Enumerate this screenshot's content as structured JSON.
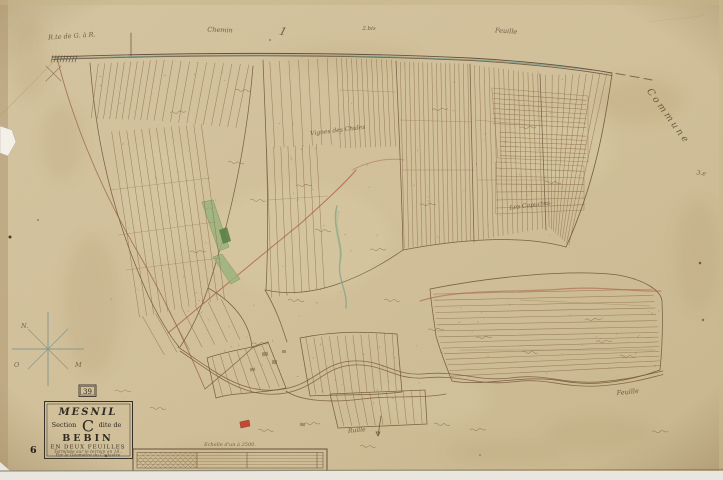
{
  "cartouche": {
    "commune_name": "MESNIL",
    "section_pre": "Section",
    "section_letter": "C",
    "section_post": "dite de",
    "lieu_name": "BEBIN",
    "subtitle": "EN DEUX FEUILLES",
    "note1": "Terminée sur le terrain en 18..",
    "note2": "Par le Géomètre du Cadastre"
  },
  "plaque_number": "39",
  "page_number": "6",
  "scale_bar": {
    "label": "Echelle d'un à 2500."
  },
  "compass": {
    "letters": [
      {
        "text": "N.",
        "x": 21,
        "y": 328
      },
      {
        "text": "O",
        "x": 14,
        "y": 367
      },
      {
        "text": "M",
        "x": 75,
        "y": 367
      }
    ]
  },
  "map_labels": [
    {
      "id": "route-top-left",
      "text": "R.te de G. à R.",
      "x": 72,
      "y": 38,
      "rot": -4,
      "size": 6.5
    },
    {
      "id": "chemin-top",
      "text": "Chemin",
      "x": 220,
      "y": 32,
      "rot": 2,
      "size": 6.5
    },
    {
      "id": "mark-1",
      "text": "1",
      "x": 282,
      "y": 35,
      "rot": 16,
      "size": 11
    },
    {
      "id": "mark-2bis",
      "text": "2.bis",
      "x": 369,
      "y": 30,
      "rot": 0,
      "size": 5.5
    },
    {
      "id": "feuille-top",
      "text": "Feuille",
      "x": 506,
      "y": 33,
      "rot": 4,
      "size": 6.5
    },
    {
      "id": "commune-right",
      "text": "Commune",
      "x": 666,
      "y": 118,
      "rot": 54,
      "size": 9.5,
      "ls": 2.5
    },
    {
      "id": "mark-3e",
      "text": "3.e",
      "x": 701,
      "y": 175,
      "rot": 8,
      "size": 6
    },
    {
      "id": "vignes-label",
      "text": "Vignes des Chules",
      "x": 338,
      "y": 132,
      "rot": -7,
      "size": 6
    },
    {
      "id": "capucins-label",
      "text": "Les Capucins",
      "x": 530,
      "y": 207,
      "rot": -7,
      "size": 6
    },
    {
      "id": "ruille-label",
      "text": "Ruille",
      "x": 357,
      "y": 432,
      "rot": -5,
      "size": 6
    },
    {
      "id": "feuille-bottom",
      "text": "Feuille",
      "x": 628,
      "y": 394,
      "rot": -6,
      "size": 6.5
    }
  ],
  "colors": {
    "paper": "#d3c29c",
    "ink": "#6a4f36",
    "dark_ink": "#5c4531",
    "teal_stream": "#6f9a8c",
    "green_parcel": "#9cb37e",
    "red_road": "#ad6248",
    "red_parcel": "#bf3d2a",
    "black_ink": "#2b2620"
  }
}
